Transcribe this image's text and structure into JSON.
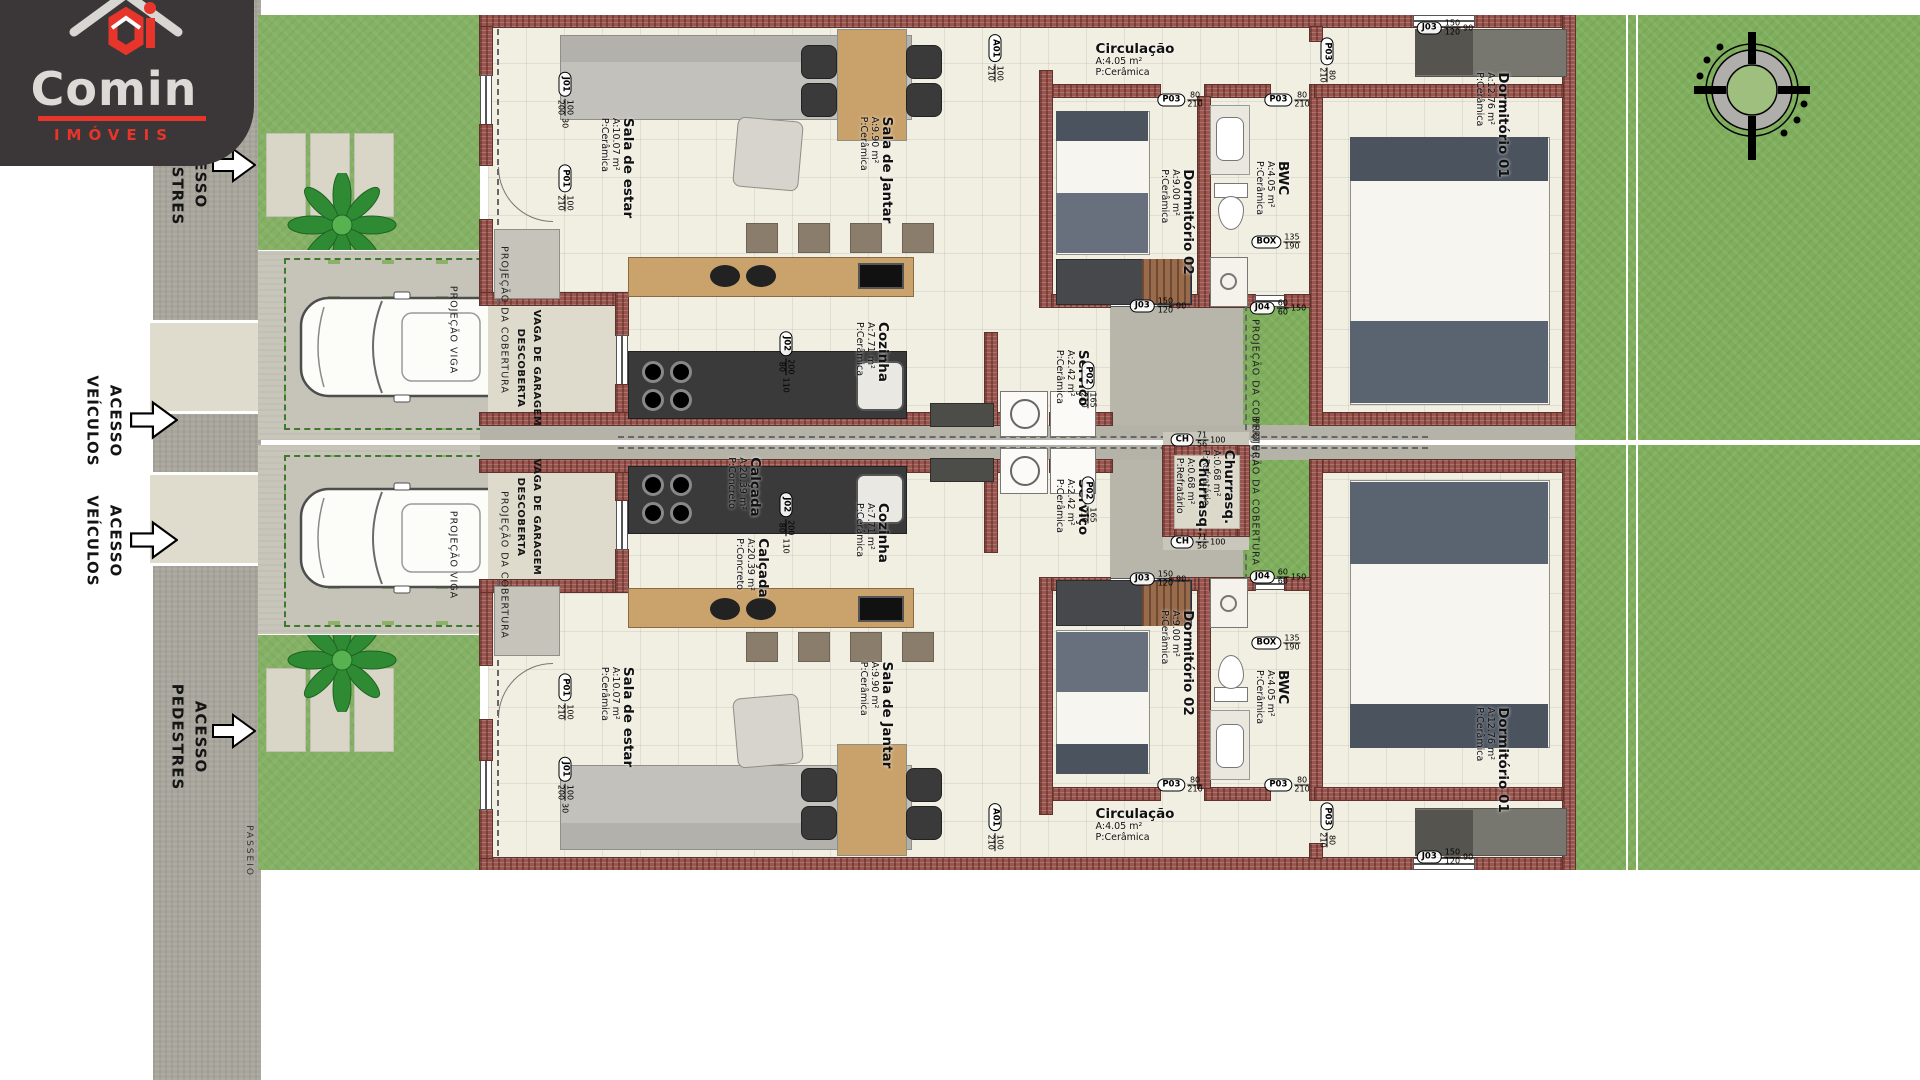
{
  "logo": {
    "brand": "Comin",
    "subtitle": "IMÓVEIS",
    "accent": "#e8352b",
    "bg": "#3b3738"
  },
  "compass": {
    "north_label": "N"
  },
  "colors": {
    "front_grass": "#85b164",
    "backyard_grass": "#7fae5c",
    "brick_wall": "#9a564e",
    "floor_tile": "#f1eee2",
    "pavement": "#c8c6bb",
    "sidewalk": "#a8a69c",
    "wood": "#c9a26b",
    "dark_counter": "#3a3a3a",
    "logo_red": "#e8352b"
  },
  "text_labels": [
    {
      "key": "passeio-top",
      "text": "PASSEIO",
      "x": 249,
      "y": 46,
      "rot": 90,
      "cls": "tiny"
    },
    {
      "key": "passeio-bottom",
      "text": "PASSEIO",
      "x": 249,
      "y": 851,
      "rot": 90,
      "cls": "tiny"
    },
    {
      "key": "acesso-pedestres-top",
      "text": "ACESSO\nPEDESTRES",
      "x": 189,
      "y": 172,
      "rot": 90,
      "cls": "access"
    },
    {
      "key": "acesso-veiculos-top",
      "text": "ACESSO\nVEÍCULOS",
      "x": 104,
      "y": 421,
      "rot": 90,
      "cls": "access"
    },
    {
      "key": "acesso-veiculos-bottom",
      "text": "ACESSO\nVEÍCULOS",
      "x": 104,
      "y": 541,
      "rot": 90,
      "cls": "access"
    },
    {
      "key": "acesso-pedestres-bottom",
      "text": "ACESSO\nPEDESTRES",
      "x": 189,
      "y": 737,
      "rot": 90,
      "cls": "access"
    },
    {
      "key": "vaga-garagem-1",
      "text": "VAGA DE GARAGEM\nDESCOBERTA",
      "x": 528,
      "y": 368,
      "rot": 90,
      "cls": "vaga"
    },
    {
      "key": "vaga-garagem-2",
      "text": "VAGA DE GARAGEM\nDESCOBERTA",
      "x": 528,
      "y": 517,
      "rot": 90,
      "cls": "vaga"
    },
    {
      "key": "projecao-cobertura-frente-1",
      "text": "PROJEÇÃO DA COBERTURA",
      "x": 503,
      "y": 320,
      "rot": 90,
      "cls": "proj"
    },
    {
      "key": "projecao-cobertura-frente-2",
      "text": "PROJEÇÃO DA COBERTURA",
      "x": 503,
      "y": 565,
      "rot": 90,
      "cls": "proj"
    },
    {
      "key": "projecao-cobertura-fundos-1",
      "text": "PROJEÇÃO DA COBERTURA",
      "x": 1254,
      "y": 393,
      "rot": 90,
      "cls": "proj"
    },
    {
      "key": "projecao-cobertura-fundos-2",
      "text": "PROJEÇÃO DA COBERTURA",
      "x": 1254,
      "y": 492,
      "rot": 90,
      "cls": "proj"
    },
    {
      "key": "projecao-viga-1",
      "text": "PROJEÇÃO VIGA",
      "x": 452,
      "y": 330,
      "rot": 90,
      "cls": "proj"
    },
    {
      "key": "projecao-viga-2",
      "text": "PROJEÇÃO VIGA",
      "x": 452,
      "y": 555,
      "rot": 90,
      "cls": "proj"
    }
  ],
  "room_labels": [
    {
      "unit": 1,
      "key": "sala-estar",
      "name": "Sala de estar",
      "area": "A:10.07 m²",
      "floor": "P:Cerâmica",
      "x": 617,
      "y": 168,
      "rot": 90
    },
    {
      "unit": 1,
      "key": "sala-jantar",
      "name": "Sala de Jantar",
      "area": "A:9.90 m²",
      "floor": "P:Cerâmica",
      "x": 876,
      "y": 170,
      "rot": 90
    },
    {
      "unit": 1,
      "key": "cozinha",
      "name": "Cozinha",
      "area": "A:7.71 m²",
      "floor": "P:Cerâmica",
      "x": 872,
      "y": 352,
      "rot": 90
    },
    {
      "unit": 1,
      "key": "servico",
      "name": "Serviço",
      "area": "A:2.42 m²",
      "floor": "P:Cerâmica",
      "x": 1072,
      "y": 378,
      "rot": 90
    },
    {
      "unit": 1,
      "key": "circulacao",
      "name": "Circulação",
      "area": "A:4.05 m²",
      "floor": "P:Cerâmica",
      "x": 1135,
      "y": 60,
      "rot": 0
    },
    {
      "unit": 1,
      "key": "dormitorio-02",
      "name": "Dormitório 02",
      "area": "A:9.00 m²",
      "floor": "P:Cerâmica",
      "x": 1177,
      "y": 222,
      "rot": 90
    },
    {
      "unit": 1,
      "key": "bwc",
      "name": "BWC",
      "area": "A:4.05 m²",
      "floor": "P:Cerâmica",
      "x": 1272,
      "y": 188,
      "rot": 90
    },
    {
      "unit": 1,
      "key": "dormitorio-01",
      "name": "Dormitório 01",
      "area": "A:12.76 m²",
      "floor": "P:Cerâmica",
      "x": 1492,
      "y": 125,
      "rot": 90
    },
    {
      "unit": 1,
      "key": "calcada",
      "name": "Calçada",
      "area": "A:20.39 m²",
      "floor": "P:Concreto",
      "x": 744,
      "y": 487,
      "rot": 90
    },
    {
      "unit": 1,
      "key": "churrasqueira",
      "name": "Churrasq.",
      "area": "A:0.68 m²",
      "floor": "P:Refratário",
      "x": 1218,
      "y": 487,
      "rot": 90
    },
    {
      "unit": 2,
      "key": "sala-estar",
      "name": "Sala de estar",
      "area": "A:10.07 m²",
      "floor": "P:Cerâmica",
      "x": 617,
      "y": 717,
      "rot": 90
    },
    {
      "unit": 2,
      "key": "sala-jantar",
      "name": "Sala de Jantar",
      "area": "A:9.90 m²",
      "floor": "P:Cerâmica",
      "x": 876,
      "y": 715,
      "rot": 90
    },
    {
      "unit": 2,
      "key": "cozinha",
      "name": "Cozinha",
      "area": "A:7.71 m²",
      "floor": "P:Cerâmica",
      "x": 872,
      "y": 533,
      "rot": 90
    },
    {
      "unit": 2,
      "key": "servico",
      "name": "Serviço",
      "area": "A:2.42 m²",
      "floor": "P:Cerâmica",
      "x": 1072,
      "y": 507,
      "rot": 90
    },
    {
      "unit": 2,
      "key": "circulacao",
      "name": "Circulação",
      "area": "A:4.05 m²",
      "floor": "P:Cerâmica",
      "x": 1135,
      "y": 825,
      "rot": 0
    },
    {
      "unit": 2,
      "key": "dormitorio-02",
      "name": "Dormitório 02",
      "area": "A:9.00 m²",
      "floor": "P:Cerâmica",
      "x": 1177,
      "y": 663,
      "rot": 90
    },
    {
      "unit": 2,
      "key": "bwc",
      "name": "BWC",
      "area": "A:4.05 m²",
      "floor": "P:Cerâmica",
      "x": 1272,
      "y": 697,
      "rot": 90
    },
    {
      "unit": 2,
      "key": "dormitorio-01",
      "name": "Dormitório 01",
      "area": "A:12.76 m²",
      "floor": "P:Cerâmica",
      "x": 1492,
      "y": 760,
      "rot": 90
    },
    {
      "unit": 2,
      "key": "calcada",
      "name": "Calçada",
      "area": "A:20.39 m²",
      "floor": "P:Concreto",
      "x": 752,
      "y": 568,
      "rot": 90
    },
    {
      "unit": 2,
      "key": "churrasqueira",
      "name": "Churrasq.",
      "area": "A:0.68 m²",
      "floor": "P:Refratário",
      "x": 1192,
      "y": 495,
      "rot": 90
    }
  ],
  "markers": [
    {
      "unit": 1,
      "id": "J01",
      "frac": "100/200",
      "sill": "30",
      "x": 565,
      "y": 100,
      "rot": 90
    },
    {
      "unit": 1,
      "id": "P01",
      "frac": "100/210",
      "sill": "",
      "x": 565,
      "y": 188,
      "rot": 90
    },
    {
      "unit": 1,
      "id": "J02",
      "frac": "200/80",
      "sill": "110",
      "x": 786,
      "y": 362,
      "rot": 90
    },
    {
      "unit": 1,
      "id": "A01",
      "frac": "100/210",
      "sill": "",
      "x": 995,
      "y": 58,
      "rot": 90
    },
    {
      "unit": 1,
      "id": "P02",
      "frac": "165/210",
      "sill": "",
      "x": 1088,
      "y": 385,
      "rot": 90
    },
    {
      "unit": 1,
      "id": "P03",
      "frac": "80/210",
      "sill": "",
      "x": 1180,
      "y": 100,
      "rot": 0
    },
    {
      "unit": 1,
      "id": "P03",
      "frac": "80/210",
      "sill": "",
      "x": 1287,
      "y": 100,
      "rot": 0
    },
    {
      "unit": 1,
      "id": "P03",
      "frac": "80/210",
      "sill": "",
      "x": 1327,
      "y": 60,
      "rot": 90
    },
    {
      "unit": 1,
      "id": "J03",
      "frac": "150/120",
      "sill": "90",
      "x": 1158,
      "y": 306,
      "rot": 0
    },
    {
      "unit": 1,
      "id": "J03",
      "frac": "150/120",
      "sill": "90",
      "x": 1445,
      "y": 28,
      "rot": 0
    },
    {
      "unit": 1,
      "id": "J04",
      "frac": "60/60",
      "sill": "150",
      "x": 1278,
      "y": 308,
      "rot": 0
    },
    {
      "unit": 1,
      "id": "BOX",
      "frac": "135/190",
      "sill": "",
      "x": 1276,
      "y": 242,
      "rot": 0
    },
    {
      "unit": 1,
      "id": "CH",
      "frac": "71/56",
      "sill": "100",
      "x": 1198,
      "y": 440,
      "rot": 0
    },
    {
      "unit": 2,
      "id": "J01",
      "frac": "100/200",
      "sill": "30",
      "x": 565,
      "y": 785,
      "rot": 90
    },
    {
      "unit": 2,
      "id": "P01",
      "frac": "100/210",
      "sill": "",
      "x": 565,
      "y": 697,
      "rot": 90
    },
    {
      "unit": 2,
      "id": "J02",
      "frac": "200/80",
      "sill": "110",
      "x": 786,
      "y": 523,
      "rot": 90
    },
    {
      "unit": 2,
      "id": "A01",
      "frac": "100/210",
      "sill": "",
      "x": 995,
      "y": 827,
      "rot": 90
    },
    {
      "unit": 2,
      "id": "P02",
      "frac": "165/210",
      "sill": "",
      "x": 1088,
      "y": 500,
      "rot": 90
    },
    {
      "unit": 2,
      "id": "P03",
      "frac": "80/210",
      "sill": "",
      "x": 1180,
      "y": 785,
      "rot": 0
    },
    {
      "unit": 2,
      "id": "P03",
      "frac": "80/210",
      "sill": "",
      "x": 1287,
      "y": 785,
      "rot": 0
    },
    {
      "unit": 2,
      "id": "P03",
      "frac": "80/210",
      "sill": "",
      "x": 1327,
      "y": 825,
      "rot": 90
    },
    {
      "unit": 2,
      "id": "J03",
      "frac": "150/120",
      "sill": "90",
      "x": 1158,
      "y": 579,
      "rot": 0
    },
    {
      "unit": 2,
      "id": "J03",
      "frac": "150/120",
      "sill": "90",
      "x": 1445,
      "y": 857,
      "rot": 0
    },
    {
      "unit": 2,
      "id": "J04",
      "frac": "60/60",
      "sill": "150",
      "x": 1278,
      "y": 577,
      "rot": 0
    },
    {
      "unit": 2,
      "id": "BOX",
      "frac": "135/190",
      "sill": "",
      "x": 1276,
      "y": 643,
      "rot": 0
    },
    {
      "unit": 2,
      "id": "CH",
      "frac": "71/56",
      "sill": "100",
      "x": 1198,
      "y": 542,
      "rot": 0
    }
  ]
}
